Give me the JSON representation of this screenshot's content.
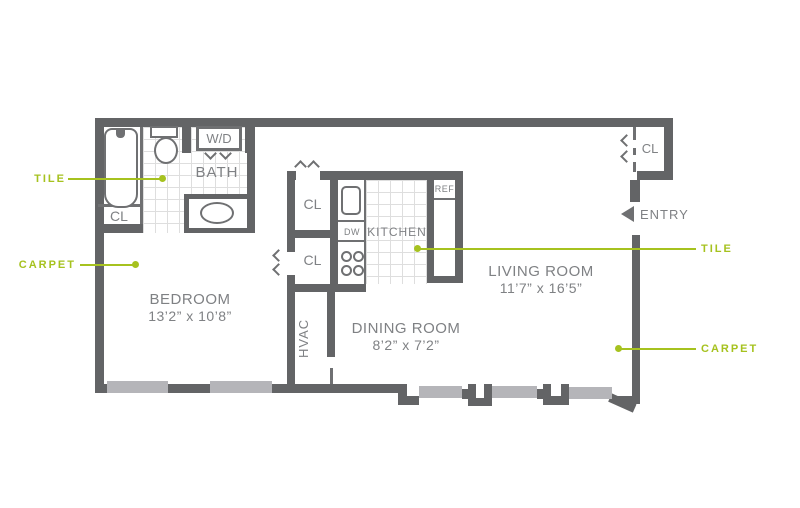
{
  "rooms": {
    "bedroom": {
      "name": "BEDROOM",
      "dims": "13’2” x 10’8”"
    },
    "dining": {
      "name": "DINING ROOM",
      "dims": "8’2” x 7’2”"
    },
    "living": {
      "name": "LIVING ROOM",
      "dims": "11’7” x 16’5”"
    },
    "kitchen": {
      "name": "KITCHEN"
    },
    "bath": {
      "name": "BATH"
    },
    "hvac": {
      "name": "HVAC"
    },
    "entry": {
      "name": "ENTRY"
    }
  },
  "closets": {
    "label": "CL"
  },
  "appliances": {
    "washer_dryer": "W/D",
    "dishwasher": "DW",
    "refrigerator": "REF"
  },
  "annotations": {
    "tile": "TILE",
    "carpet": "CARPET"
  },
  "colors": {
    "wall": "#636466",
    "window": "#b5b5b9",
    "accent_green": "#a6c21f",
    "label_gray": "#7f8184",
    "tile_line": "#dedede"
  }
}
